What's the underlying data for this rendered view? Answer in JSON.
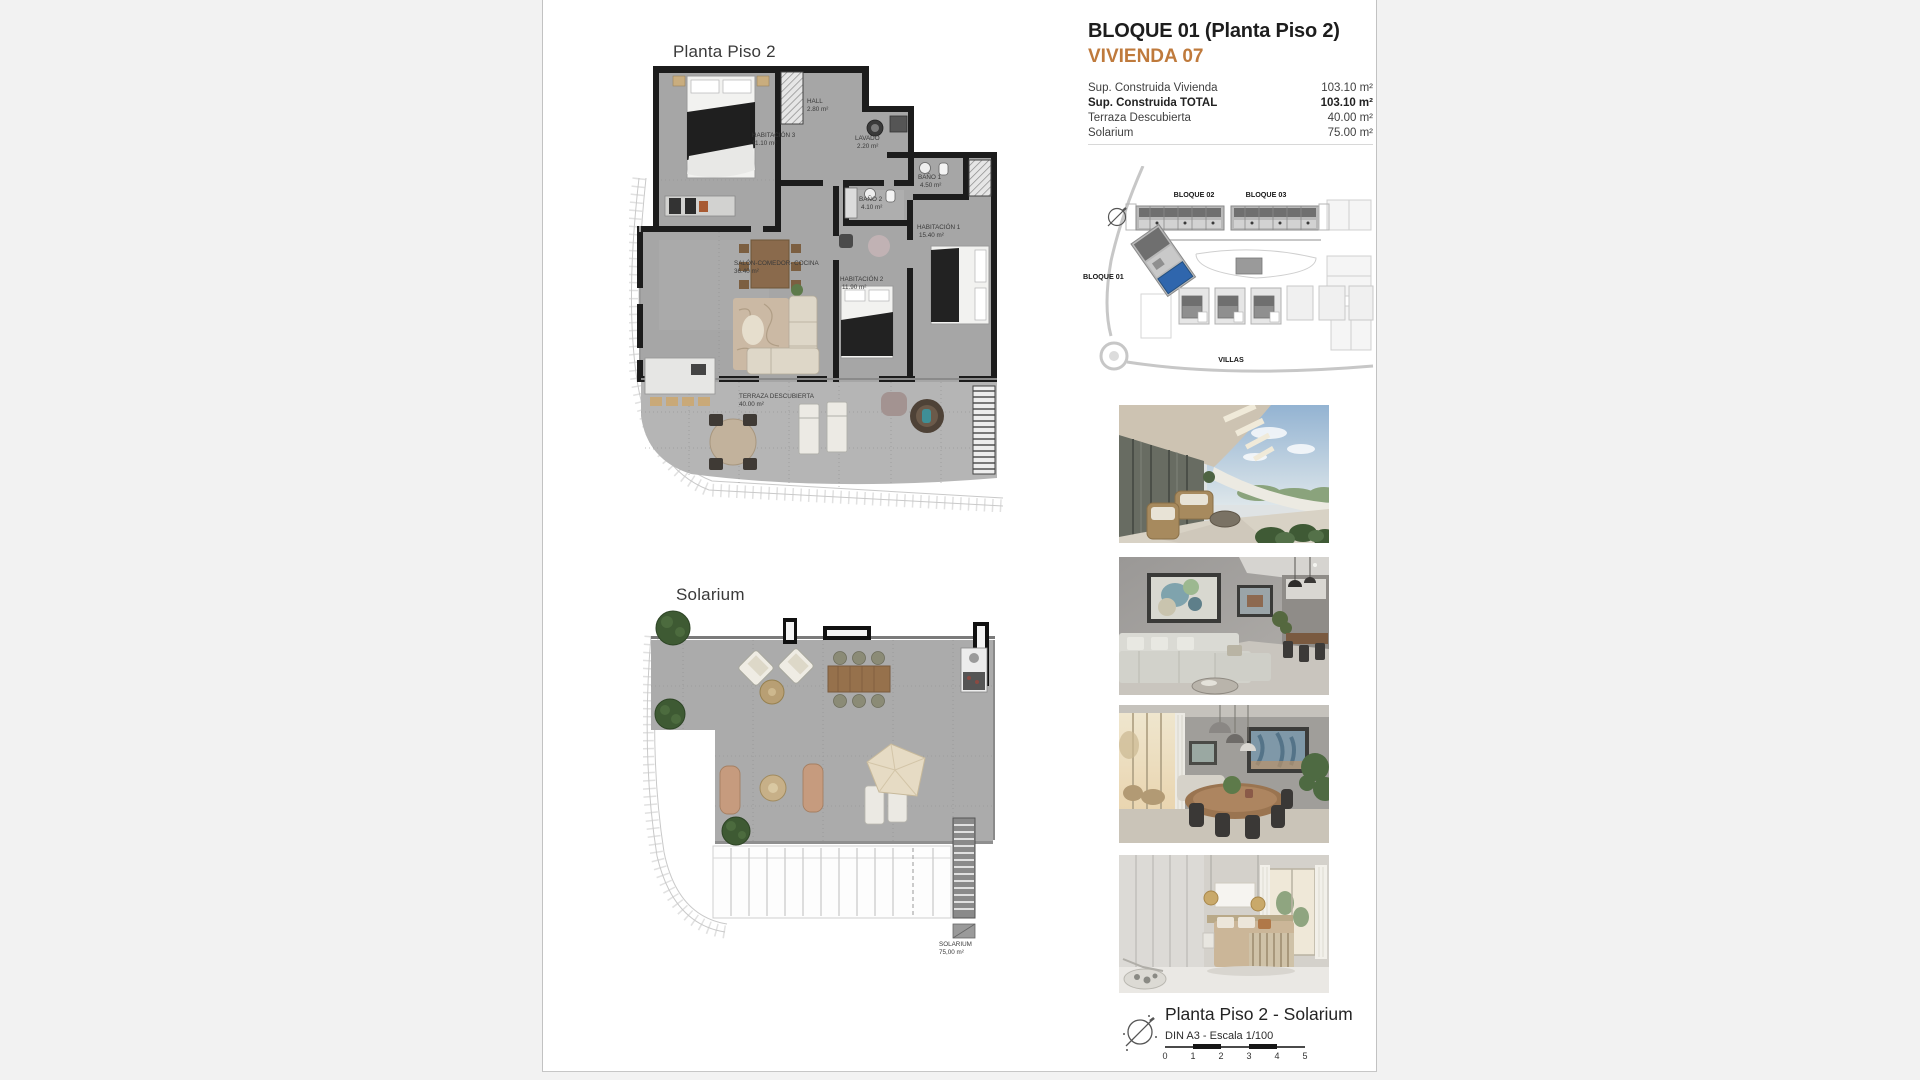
{
  "info": {
    "title": "BLOQUE 01  (Planta Piso 2)",
    "subtitle": "VIVIENDA 07",
    "rows": [
      {
        "label": "Sup. Construida Vivienda",
        "value": "103.10 m²"
      },
      {
        "label": "Sup. Construida TOTAL",
        "value": "103.10 m²"
      },
      {
        "label": "Terraza Descubierta",
        "value": "40.00 m²"
      },
      {
        "label": "Solarium",
        "value": "75.00 m²"
      }
    ]
  },
  "plan1": {
    "title": "Planta Piso 2",
    "rooms": [
      {
        "name": "HABITACIÓN 3",
        "area": "11.10 m²"
      },
      {
        "name": "HALL",
        "area": "2.80 m²"
      },
      {
        "name": "LAVADO",
        "area": "2.20 m²"
      },
      {
        "name": "BAÑO 2",
        "area": "4.10 m²"
      },
      {
        "name": "BAÑO 1",
        "area": "4.50 m²"
      },
      {
        "name": "HABITACIÓN 1",
        "area": "15.40 m²"
      },
      {
        "name": "SALÓN-COMEDOR- COCINA",
        "area": "36.40 m²"
      },
      {
        "name": "HABITACIÓN 2",
        "area": "11.90 m²"
      },
      {
        "name": "TERRAZA DESCUBIERTA",
        "area": "40.00 m²"
      }
    ]
  },
  "plan2": {
    "title": "Solarium",
    "room": {
      "name": "SOLARIUM",
      "area": "75,00 m²"
    }
  },
  "siteplan": {
    "labels": {
      "b1": "BLOQUE 01",
      "b2": "BLOQUE 02",
      "b3": "BLOQUE 03",
      "villas": "VILLAS"
    },
    "highlight_color": "#2f66ad"
  },
  "photos": [
    {
      "name": "terrace-exterior-photo"
    },
    {
      "name": "living-room-photo"
    },
    {
      "name": "dining-room-photo"
    },
    {
      "name": "bedroom-photo"
    }
  ],
  "footer": {
    "title": "Planta Piso 2 - Solarium",
    "subtitle": "DIN A3 - Escala 1/100",
    "scale_ticks": [
      "0",
      "1",
      "2",
      "3",
      "4",
      "5"
    ]
  },
  "colors": {
    "accent": "#bf7a3c"
  }
}
